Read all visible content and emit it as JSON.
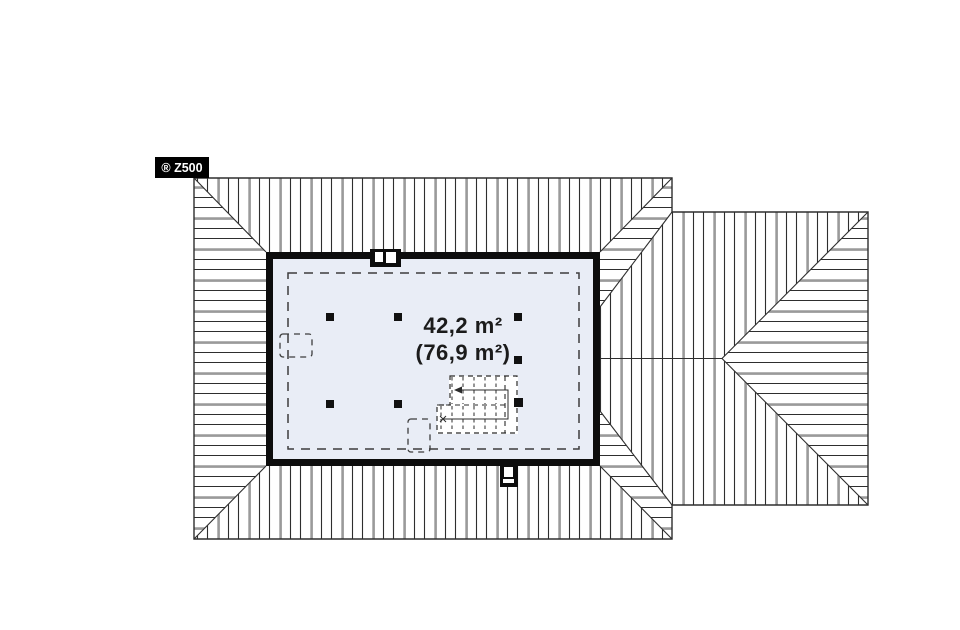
{
  "brand_badge": {
    "label": "® Z500"
  },
  "plan": {
    "area_primary": "42,2 m²",
    "area_secondary": "(76,9 m²)"
  },
  "colors": {
    "room_fill": "#e9edf6",
    "line": "#2e2e2e",
    "wall": "#0d0d0d",
    "badge_bg": "#000000",
    "badge_text": "#ffffff"
  }
}
